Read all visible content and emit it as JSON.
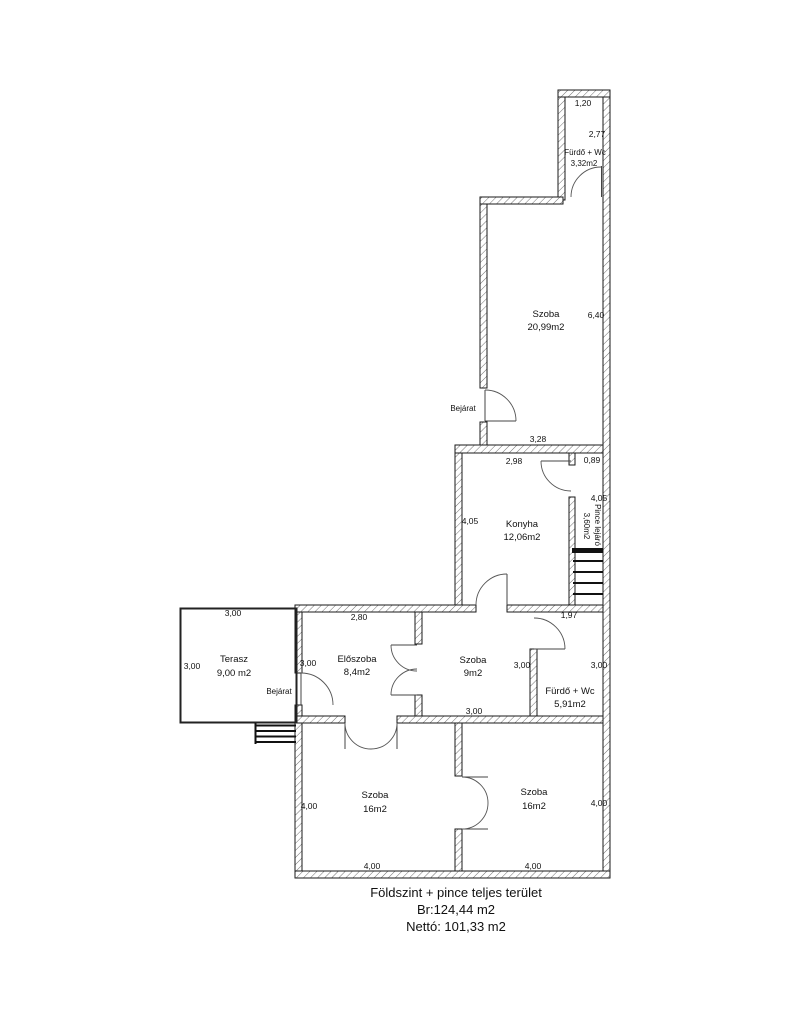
{
  "plan": {
    "bathroom_top": {
      "name": "Fürdő + Wc",
      "area": "3,32m2",
      "width": "1,20",
      "height": "2,77"
    },
    "living_room": {
      "name": "Szoba",
      "area": "20,99m2",
      "width": "3,28",
      "height": "6,40",
      "entrance": "Bejárat"
    },
    "kitchen": {
      "name": "Konyha",
      "area": "12,06m2",
      "width": "2,98",
      "height": "4,05"
    },
    "basement_stairs": {
      "name": "Pince lejáró",
      "area": "3,60m2",
      "width": "0,89",
      "height": "4,05"
    },
    "terrace": {
      "name": "Terasz",
      "area": "9,00 m2",
      "width": "3,00",
      "height": "3,00",
      "entrance": "Bejárat"
    },
    "hallway": {
      "name": "Előszoba",
      "area": "8,4m2",
      "width": "2,80",
      "height": "3,00"
    },
    "room9": {
      "name": "Szoba",
      "area": "9m2",
      "width": "3,00",
      "height": "3,00"
    },
    "bathroom_main": {
      "name": "Fürdő + Wc",
      "area": "5,91m2",
      "width": "1,97",
      "height": "3,00"
    },
    "room16_left": {
      "name": "Szoba",
      "area": "16m2",
      "width": "4,00",
      "height": "4,00"
    },
    "room16_right": {
      "name": "Szoba",
      "area": "16m2",
      "width": "4,00",
      "height": "4,00"
    }
  },
  "caption": {
    "title": "Földszint + pince teljes terület",
    "gross": "Br:124,44 m2",
    "net": "Nettó: 101,33 m2"
  }
}
